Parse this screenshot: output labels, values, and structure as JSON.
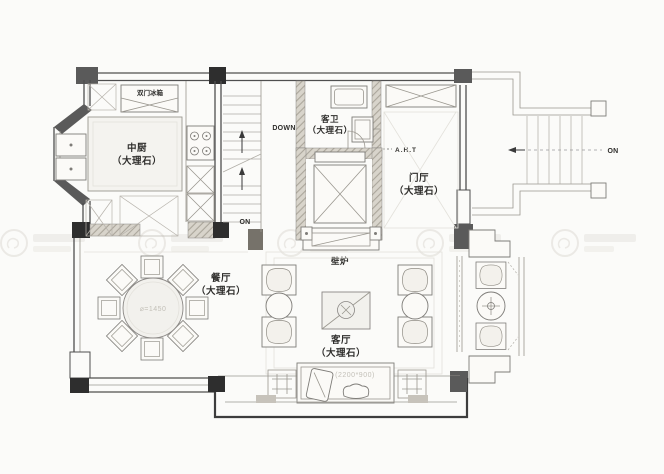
{
  "plan": {
    "type": "residential-floor-plan",
    "rooms": {
      "kitchen": {
        "name": "中厨",
        "material": "（大理石）"
      },
      "guest_bath": {
        "name": "客卫",
        "material": "（大理石）"
      },
      "foyer": {
        "name": "门厅",
        "material": "（大理石）"
      },
      "dining": {
        "name": "餐厅",
        "material": "（大理石）"
      },
      "living": {
        "name": "客厅",
        "material": "（大理石）"
      }
    },
    "annotations": {
      "fridge": "双门冰箱",
      "fireplace": "壁炉",
      "stair_down": "DOWN",
      "stair_on_interior": "ON",
      "stair_on_exterior": "ON",
      "elevator_note": "A.H.T",
      "dining_table_diameter": "⌀=1450",
      "sofa_size": "(2200*900)"
    },
    "colors": {
      "background": "#fbfbf9",
      "wall_line": "#4f4f4f",
      "column_dark": "#2e2e2e",
      "column_gray": "#5a5a5a",
      "hatch_fill": "#d8d4cb",
      "furniture_line": "#7e7c78",
      "label_text": "#2e2d2b",
      "dimension_text": "#c3c0b8",
      "watermark": "#dfdcd6"
    }
  }
}
